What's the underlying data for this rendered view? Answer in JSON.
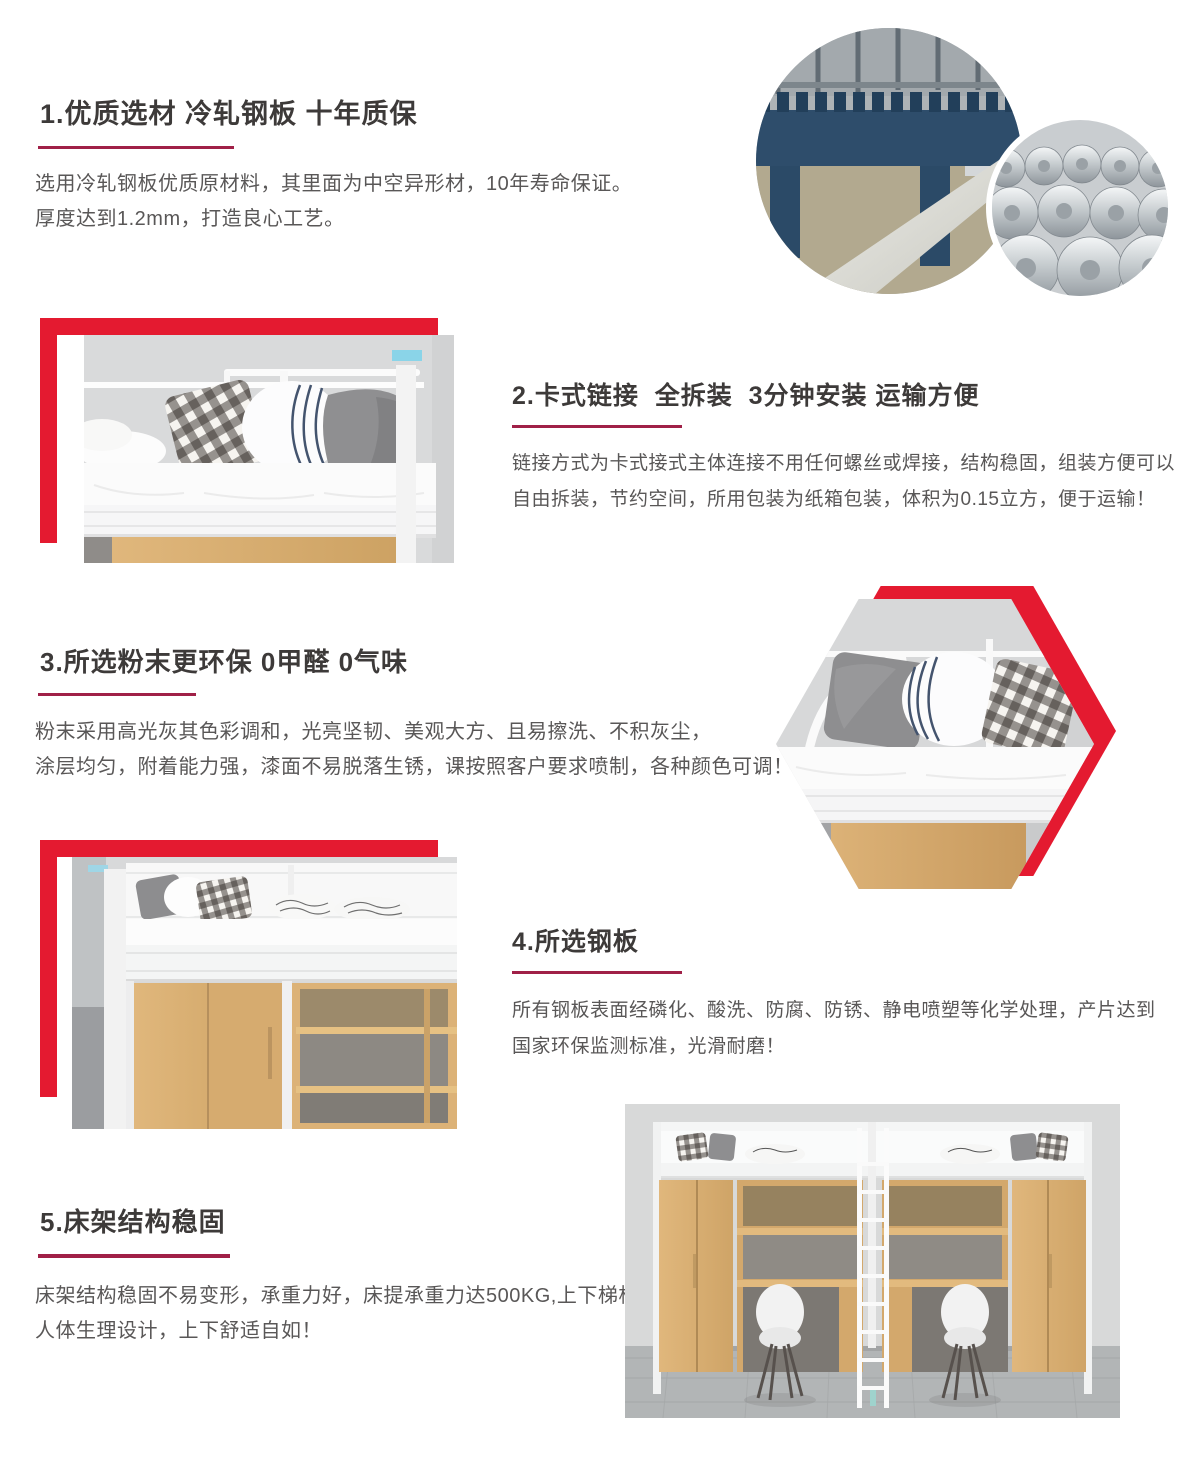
{
  "page": {
    "type": "product-detail-features",
    "background": "#ffffff"
  },
  "colors": {
    "accent_red": "#e41a30",
    "underline_crimson": "#a02047",
    "title_text": "#3d3a39",
    "body_text": "#595757",
    "wood": "#d8ae74",
    "wall_gray": "#d8d9da",
    "steel_navy": "#2e4d6b"
  },
  "sections": [
    {
      "title": "1.优质选材 冷轧钢板 十年质保",
      "body_lines": [
        "选用冷轧钢板优质原材料，其里面为中空异形材，10年寿命保证。",
        "厚度达到1.2mm，打造良心工艺。"
      ],
      "image": "factory-rolling-machine-and-steel-coils-circles"
    },
    {
      "title": "2.卡式链接  全拆装  3分钟安装 运输方便",
      "body_lines": [
        "链接方式为卡式接式主体连接不用任何螺丝或焊接，结构稳固，组装方便可以",
        "自由拆装，节约空间，所用包装为纸箱包装，体积为0.15立方，便于运输！"
      ],
      "image": "bunk-bed-top-corner-photo"
    },
    {
      "title": "3.所选粉末更环保 0甲醛 0气味",
      "body_lines": [
        "粉末采用高光灰其色彩调和，光亮坚韧、美观大方、且易擦洗、不积灰尘，",
        "涂层均匀，附着能力强，漆面不易脱落生锈，课按照客户要求喷制，各种颜色可调！"
      ],
      "image": "bunk-bed-hexagon-photo"
    },
    {
      "title": "4.所选钢板",
      "body_lines": [
        "所有钢板表面经磷化、酸洗、防腐、防锈、静电喷塑等化学处理，产片达到",
        "国家环保监测标准，光滑耐磨！"
      ],
      "image": "loft-bed-with-wardrobe-photo"
    },
    {
      "title": "5.床架结构稳固",
      "body_lines": [
        "床架结构稳固不易变形，承重力好，床提承重力达500KG,上下梯根据",
        "人体生理设计，上下舒适自如！"
      ],
      "image": "double-loft-bed-desk-set-photo"
    }
  ]
}
